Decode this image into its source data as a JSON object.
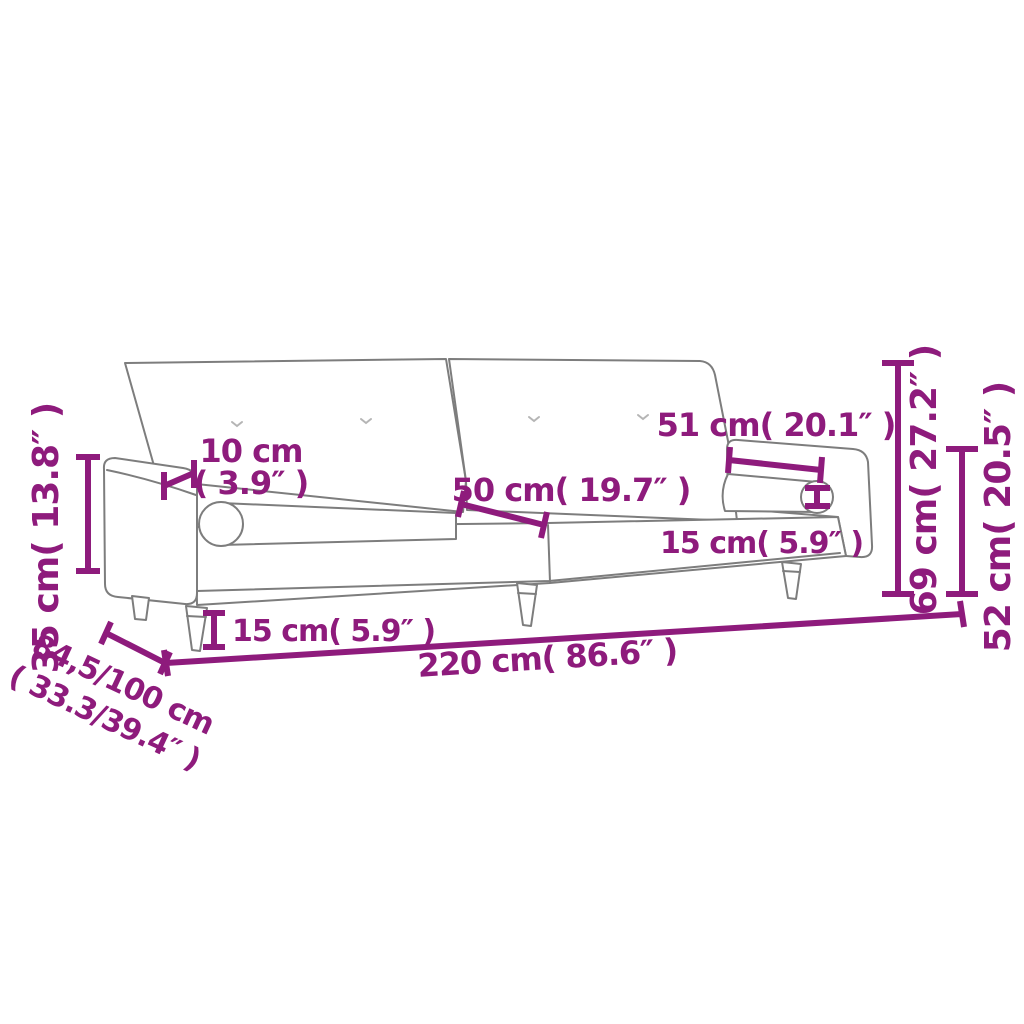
{
  "diagram": {
    "type": "furniture-dimension-diagram",
    "subject": "sofa bed with two backrest panels, armrests and bolster cushions",
    "colors": {
      "dimension_accent": "#8e1b7c",
      "drawing_outline": "#7d7d7d",
      "background": "#ffffff"
    },
    "labels": {
      "armrest_height": "35 cm( 13.8″ )",
      "armrest_width_cm": "10 cm",
      "armrest_width_in": "( 3.9″ )",
      "seat_section_width": "50 cm( 19.7″ )",
      "bolster_length": "51 cm( 20.1″ )",
      "bolster_diameter": "15 cm( 5.9″ )",
      "leg_height": "15 cm( 5.9″ )",
      "total_width": "220 cm( 86.6″ )",
      "depth_cm": "84,5/100 cm",
      "depth_in": "( 33.3/39.4″ )",
      "total_height": "69 cm( 27.2″ )",
      "seat_back_height": "52 cm( 20.5″ )"
    }
  }
}
